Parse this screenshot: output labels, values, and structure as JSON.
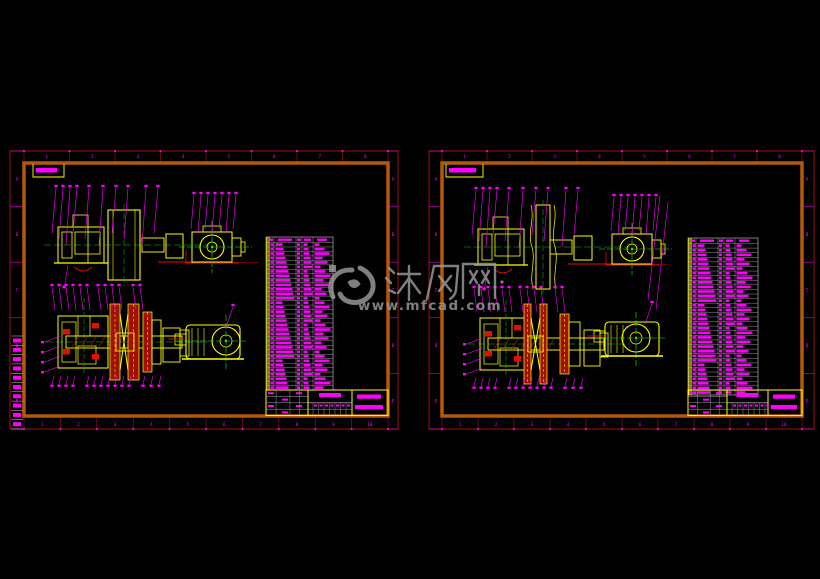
{
  "watermark": {
    "brand": "沐风网",
    "url": "www.mfcad.com",
    "color": "#9c9c9c"
  },
  "colors": {
    "background": "#000000",
    "yellow": "#ffff00",
    "magenta": "#ff00ff",
    "green": "#00c800",
    "bright_green": "#00ff00",
    "red": "#e01000",
    "dark_red": "#8b0000",
    "border_orange": "#b4580a",
    "trim_red": "#c81414",
    "table_line_gray": "#b8b8b8",
    "watermark_gray": "#9c9c9c"
  },
  "sheets": {
    "left": {
      "zone_numbers_top": [
        "1",
        "2",
        "3",
        "4",
        "5",
        "6",
        "7",
        "8"
      ],
      "zone_numbers_bottom": [
        "1",
        "2",
        "3",
        "4",
        "5",
        "6",
        "7",
        "8",
        "9",
        "10"
      ],
      "zone_letters": [
        "A",
        "B",
        "C",
        "D",
        "E"
      ],
      "bom_rows": 33,
      "revision_rows": 10
    },
    "right": {
      "zone_numbers_top": [
        "1",
        "2",
        "3",
        "4",
        "5",
        "6",
        "7",
        "8"
      ],
      "zone_numbers_bottom": [
        "1",
        "2",
        "3",
        "4",
        "5",
        "6",
        "7",
        "8",
        "9",
        "10"
      ],
      "zone_letters": [
        "A",
        "B",
        "C",
        "D",
        "E"
      ],
      "bom_rows": 33,
      "revision_rows": 0
    }
  }
}
